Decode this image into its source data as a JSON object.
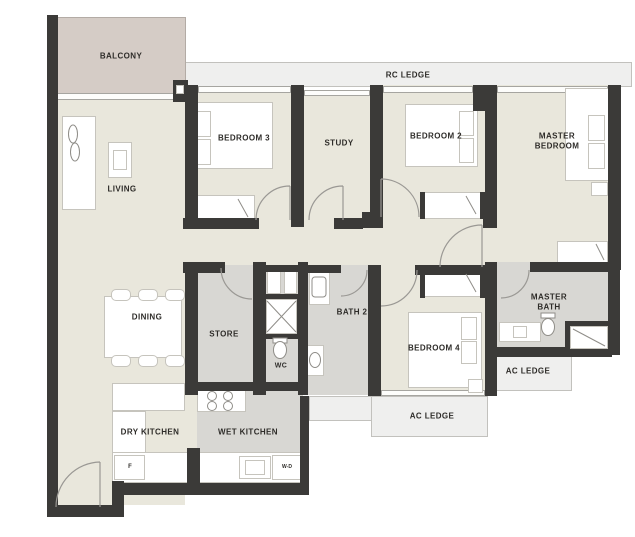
{
  "plan": {
    "rooms": {
      "balcony": "BALCONY",
      "living": "LIVING",
      "bedroom3": "BEDROOM 3",
      "study": "STUDY",
      "bedroom2": "BEDROOM 2",
      "master_bedroom": "MASTER BEDROOM",
      "dining": "DINING",
      "store": "STORE",
      "wc": "WC",
      "bath2": "BATH 2",
      "bedroom4": "BEDROOM 4",
      "master_bath": "MASTER BATH",
      "dry_kitchen": "DRY KITCHEN",
      "wet_kitchen": "WET KITCHEN"
    },
    "ledges": {
      "rc": "RC LEDGE",
      "ac": "AC LEDGE"
    },
    "appliances": {
      "fridge": "F",
      "washer_dryer": "W-D"
    },
    "colors": {
      "wall": "#3b3a38",
      "floor": "#e9e7dc",
      "wet_floor": "#d8d7d3",
      "balcony_floor": "#d5ccc6",
      "ledge": "#efefee",
      "outline": "#9a9894"
    }
  }
}
